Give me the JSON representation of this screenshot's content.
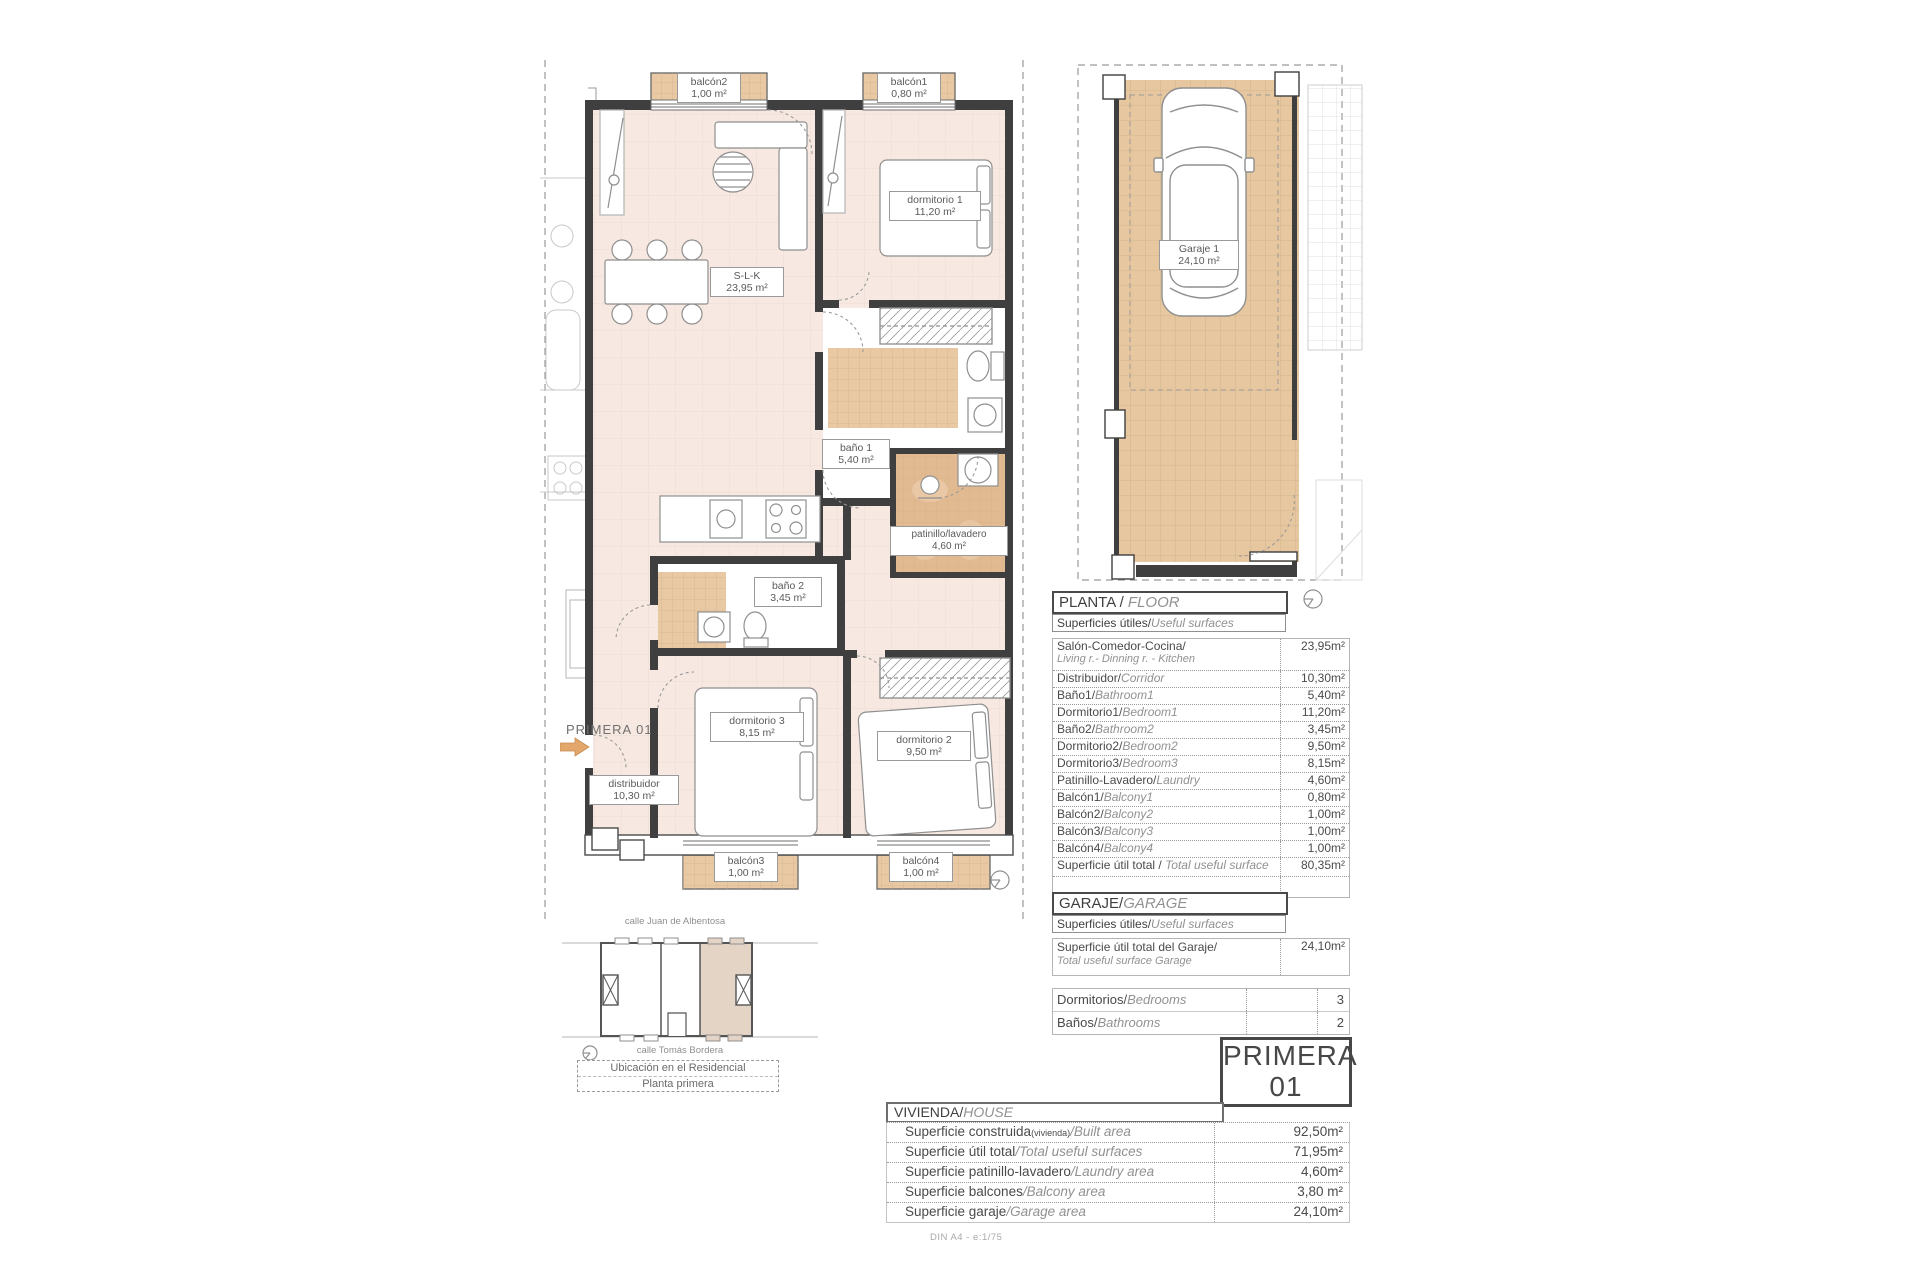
{
  "plan": {
    "arrow_label": "PRIMERA 01",
    "rooms": {
      "slk": {
        "name": "S-L-K",
        "area": "23,95 m²"
      },
      "dormitorio1": {
        "name": "dormitorio 1",
        "area": "11,20 m²"
      },
      "bano1": {
        "name": "baño 1",
        "area": "5,40 m²"
      },
      "patinillo": {
        "name": "patinillo/lavadero",
        "area": "4,60 m²"
      },
      "bano2": {
        "name": "baño 2",
        "area": "3,45 m²"
      },
      "dormitorio3": {
        "name": "dormitorio 3",
        "area": "8,15 m²"
      },
      "dormitorio2": {
        "name": "dormitorio 2",
        "area": "9,50 m²"
      },
      "distribuidor": {
        "name": "distribuidor",
        "area": "10,30 m²"
      },
      "balcon1": {
        "name": "balcón1",
        "area": "0,80 m²"
      },
      "balcon2": {
        "name": "balcón2",
        "area": "1,00 m²"
      },
      "balcon3": {
        "name": "balcón3",
        "area": "1,00 m²"
      },
      "balcon4": {
        "name": "balcón4",
        "area": "1,00 m²"
      },
      "garaje1": {
        "name": "Garaje 1",
        "area": "24,10 m²"
      }
    }
  },
  "floor_section": {
    "title_es": "PLANTA / ",
    "title_en": "FLOOR",
    "sub_es": "Superficies útiles/",
    "sub_en": "Useful surfaces",
    "rows": [
      {
        "es": "Salón-Comedor-Cocina/",
        "en": "Living r.- Dinning r. - Kitchen",
        "value": "23,95m²"
      },
      {
        "es": "Distribuidor/",
        "en": "Corridor",
        "value": "10,30m²"
      },
      {
        "es": "Baño1/",
        "en": "Bathroom1",
        "value": "5,40m²"
      },
      {
        "es": "Dormitorio1/",
        "en": "Bedroom1",
        "value": "11,20m²"
      },
      {
        "es": "Baño2/",
        "en": "Bathroom2",
        "value": "3,45m²"
      },
      {
        "es": "Dormitorio2/",
        "en": "Bedroom2",
        "value": "9,50m²"
      },
      {
        "es": "Dormitorio3/",
        "en": "Bedroom3",
        "value": "8,15m²"
      },
      {
        "es": "Patinillo-Lavadero/",
        "en": "Laundry",
        "value": "4,60m²"
      },
      {
        "es": "Balcón1/",
        "en": "Balcony1",
        "value": "0,80m²"
      },
      {
        "es": "Balcón2/",
        "en": "Balcony2",
        "value": "1,00m²"
      },
      {
        "es": "Balcón3/",
        "en": "Balcony3",
        "value": "1,00m²"
      },
      {
        "es": "Balcón4/",
        "en": "Balcony4",
        "value": "1,00m²"
      }
    ],
    "total": {
      "es": "Superficie útil total / ",
      "en": "Total useful surface",
      "value": "80,35m²"
    }
  },
  "garage_section": {
    "title_es": "GARAJE/",
    "title_en": "GARAGE",
    "sub_es": "Superficies útiles/",
    "sub_en": "Useful surfaces",
    "row": {
      "es": "Superficie útil total del Garaje/",
      "en": "Total useful surface Garage",
      "value": "24,10m²"
    }
  },
  "counts": {
    "rows": [
      {
        "es": "Dormitorios/",
        "en": "Bedrooms",
        "value": "3"
      },
      {
        "es": "Baños/",
        "en": "Bathrooms",
        "value": "2"
      }
    ]
  },
  "unit_badge": {
    "line1": "PRIMERA",
    "line2": "01"
  },
  "house_section": {
    "title_es": "VIVIENDA/",
    "title_en": "HOUSE",
    "rows": [
      {
        "es": "Superficie construida",
        "sub": "(vivienda)",
        "en": "/Built area",
        "value": "92,50m²"
      },
      {
        "es": "Superficie útil total",
        "sub": "",
        "en": "/Total useful surfaces",
        "value": "71,95m²"
      },
      {
        "es": "Superficie patinillo-lavadero",
        "sub": "",
        "en": "/Laundry area",
        "value": "4,60m²"
      },
      {
        "es": "Superficie balcones",
        "sub": "",
        "en": "/Balcony area",
        "value": "3,80 m²"
      },
      {
        "es": "Superficie garaje",
        "sub": "",
        "en": "/Garage area",
        "value": "24,10m²"
      }
    ]
  },
  "location": {
    "street_top": "calle Juan de Albentosa",
    "street_bottom": "calle Tomás Bordera",
    "box_line1": "Ubicación en el Residencial",
    "box_line2": "Planta primera"
  },
  "footer": "DIN A4 - e:1/75",
  "colors": {
    "floor": "#f7e9e1",
    "tile": "#e8c9a4",
    "tile_dark": "#e2b audited"
  }
}
